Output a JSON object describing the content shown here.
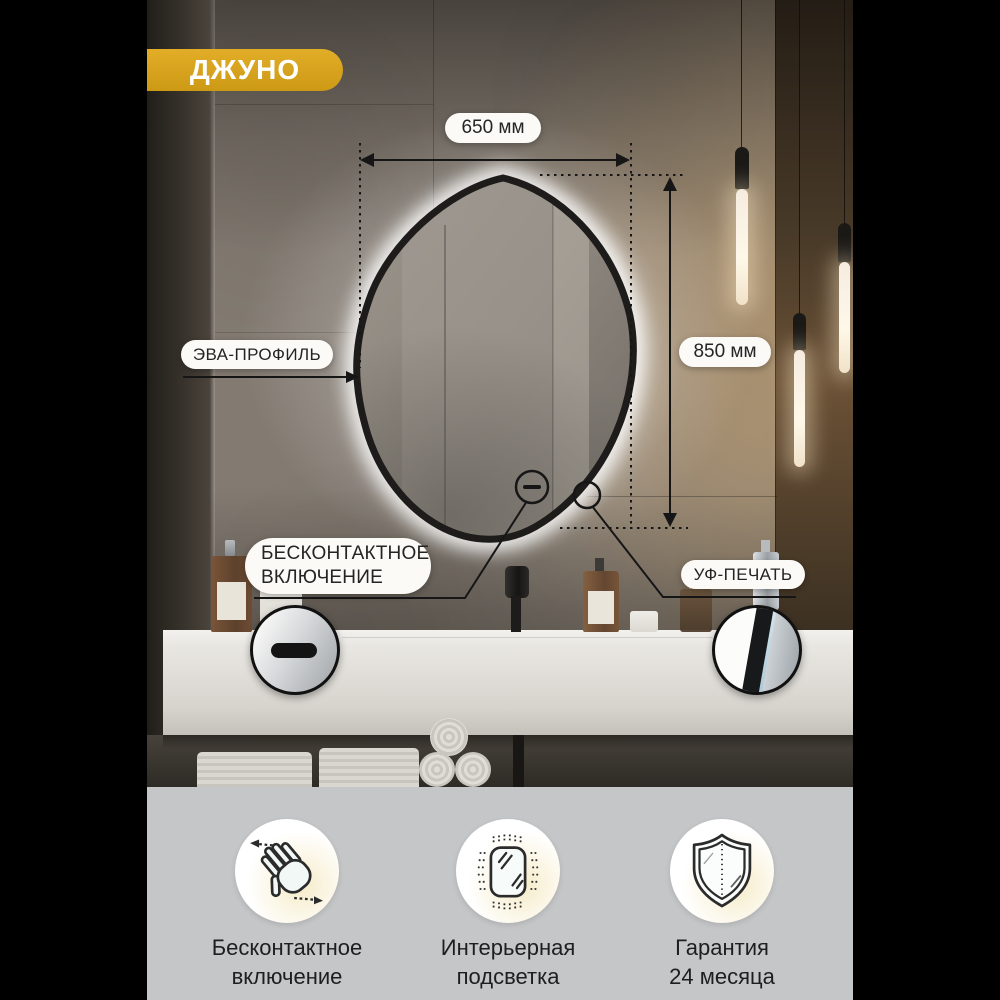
{
  "badge": {
    "label": "ДЖУНО"
  },
  "annotations": {
    "width_label": "650 мм",
    "height_label": "850 мм",
    "profile_label": "ЭВА-ПРОФИЛЬ",
    "touchless_line1": "БЕСКОНТАКТНОЕ",
    "touchless_line2": "ВКЛЮЧЕНИЕ",
    "uv_label": "УФ-ПЕЧАТЬ"
  },
  "features": [
    {
      "icon": "wave-hand-icon",
      "line1": "Бесконтактное",
      "line2": "включение"
    },
    {
      "icon": "backlit-mirror-icon",
      "line1": "Интерьерная",
      "line2": "подсветка"
    },
    {
      "icon": "shield-icon",
      "line1": "Гарантия",
      "line2": "24 месяца"
    }
  ],
  "colors": {
    "accent_gold": "#d8a51e",
    "band_gray": "#c5c6c8",
    "label_bg": "#fbfaf7",
    "line_color": "#161616"
  }
}
